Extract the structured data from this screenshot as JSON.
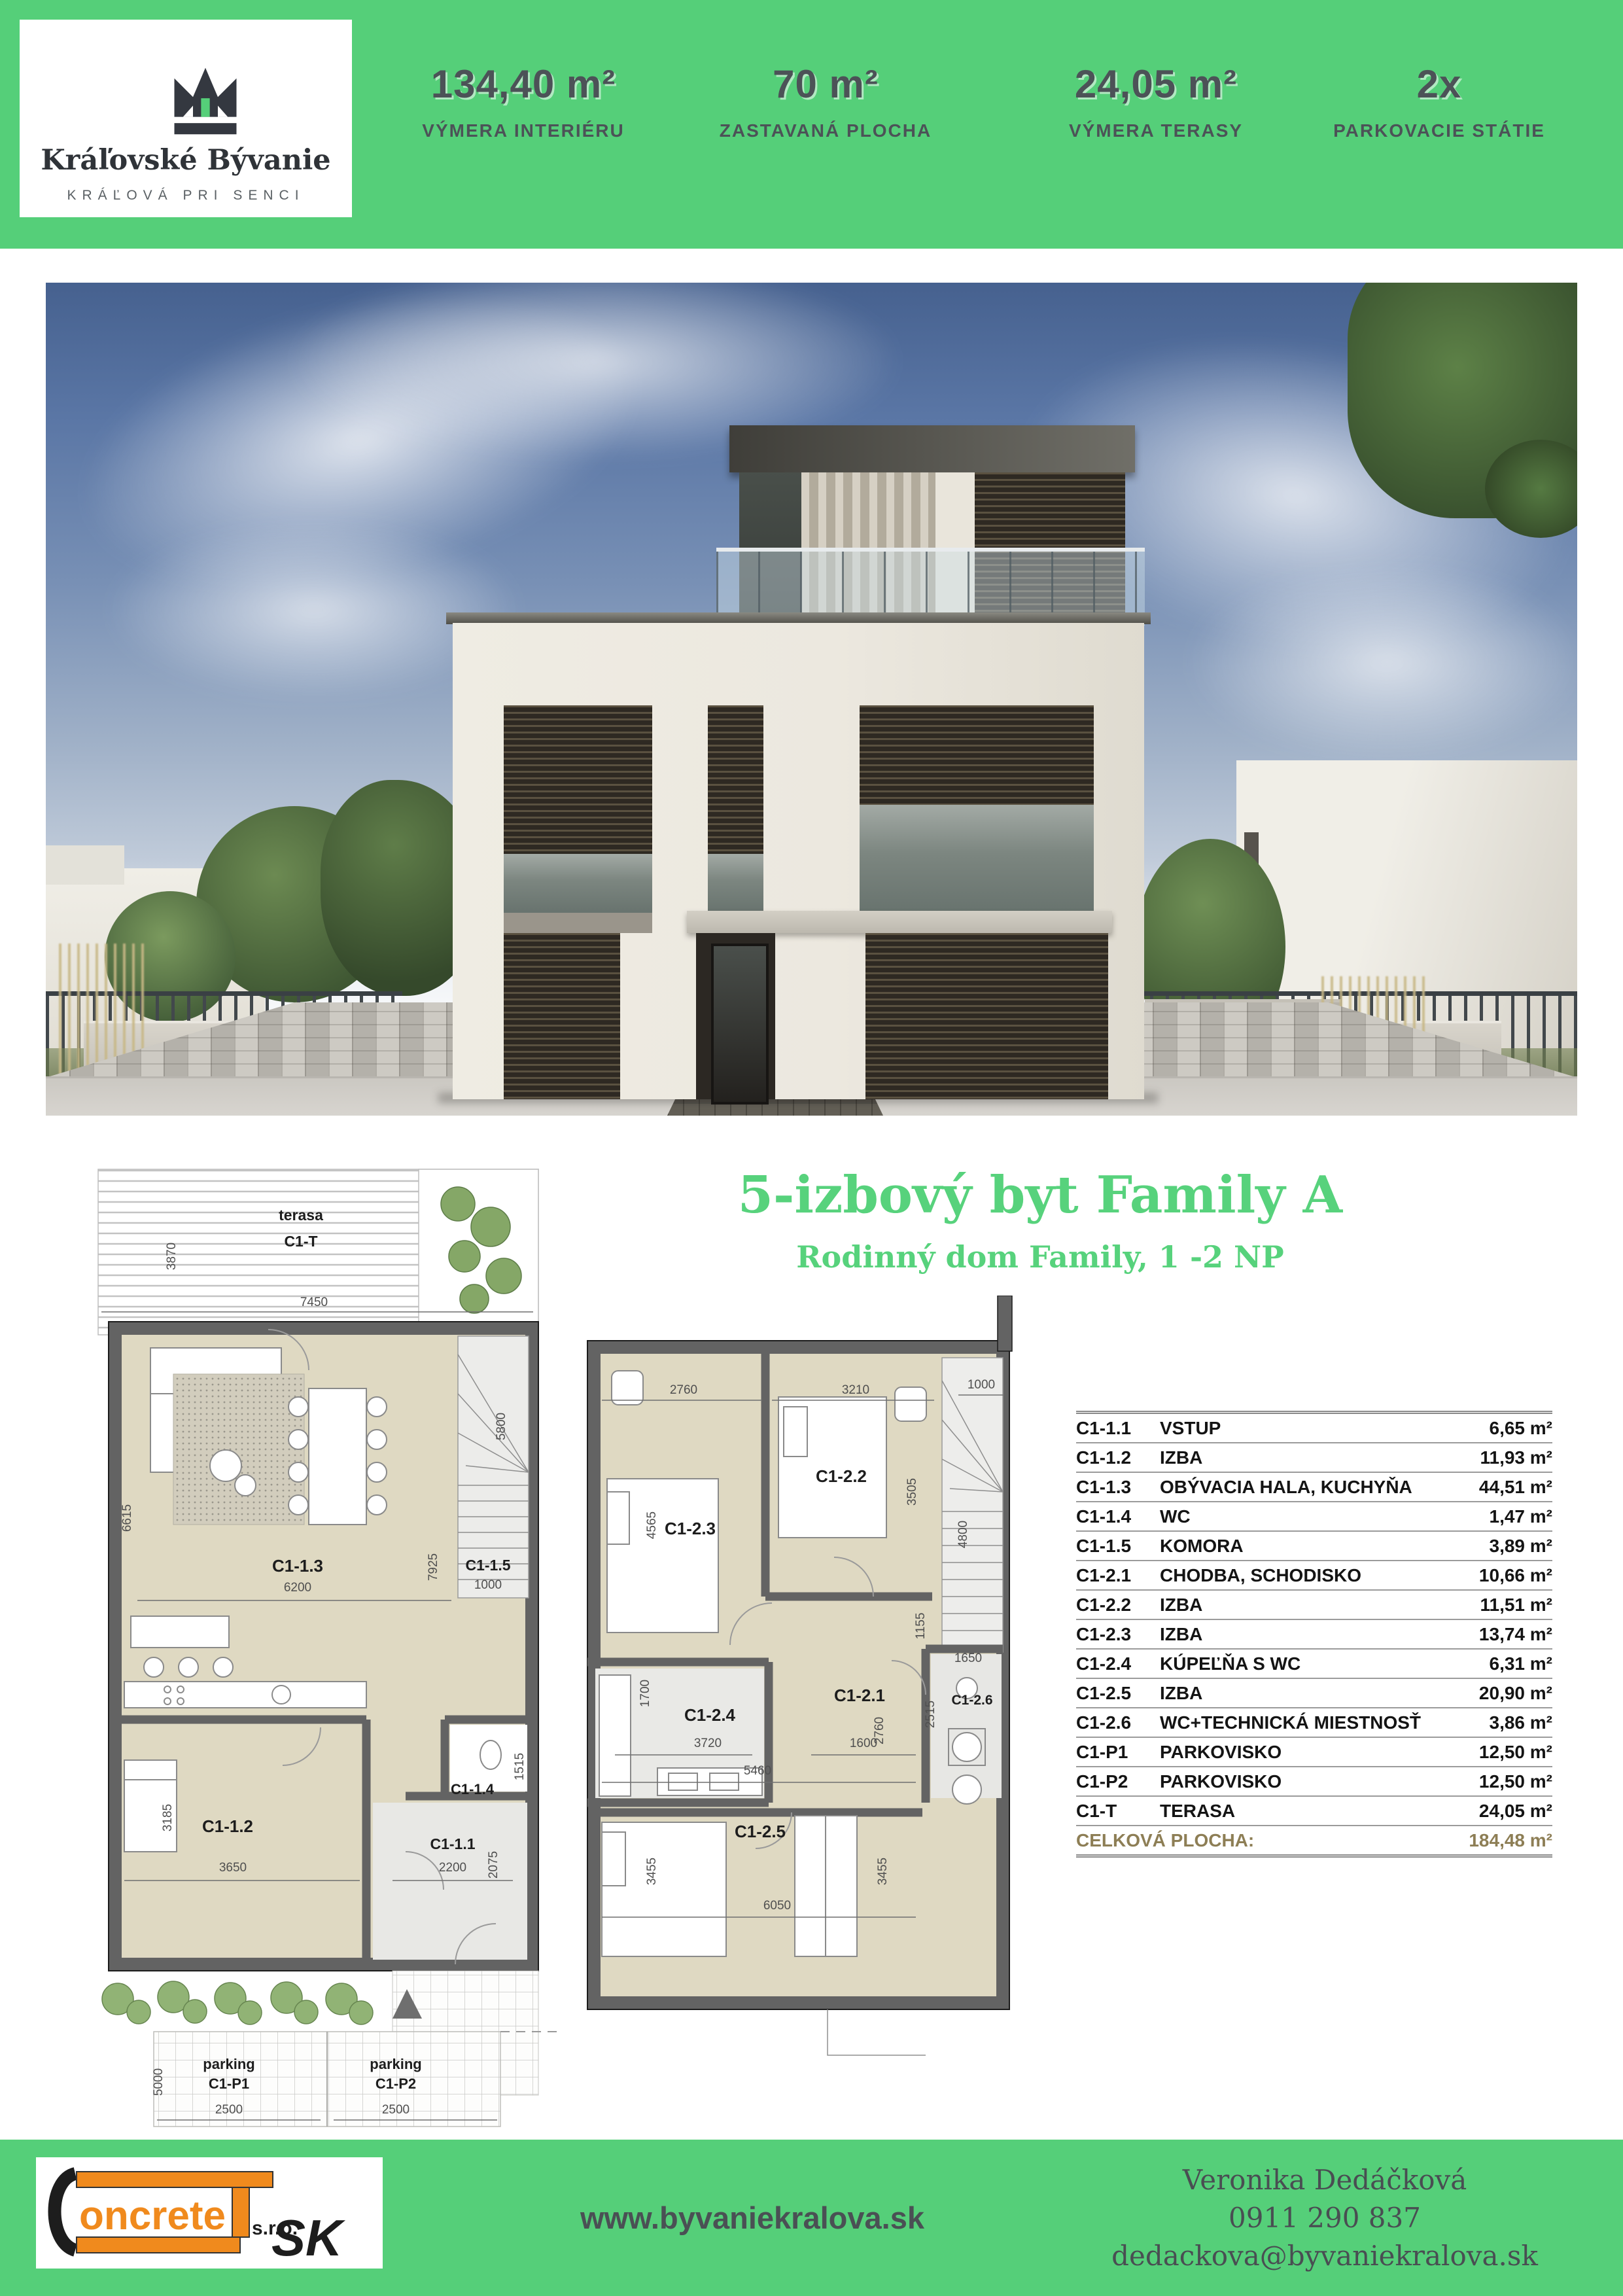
{
  "colors": {
    "green": "#55CF79",
    "dark_text": "#4C5257",
    "table_total": "#8D7E55",
    "logo_orange": "#F08A1D"
  },
  "header": {
    "logo": {
      "title": "Kráľovské Bývanie",
      "subtitle": "KRÁĽOVÁ PRI SENCI"
    },
    "stats": [
      {
        "value": "134,40 m²",
        "label": "VÝMERA INTERIÉRU"
      },
      {
        "value": "70 m²",
        "label": "ZASTAVANÁ PLOCHA"
      },
      {
        "value": "24,05 m²",
        "label": "VÝMERA TERASY"
      },
      {
        "value": "2x",
        "label": "PARKOVACIE STÁTIE"
      }
    ]
  },
  "section": {
    "title": "5-izbový byt Family A",
    "subtitle": "Rodinný dom Family,  1 -2 NP"
  },
  "plans": {
    "ground": {
      "terrace": {
        "name": "terasa",
        "code": "C1-T"
      },
      "rooms": {
        "c11": "C1-1.1",
        "c12": "C1-1.2",
        "c13": "C1-1.3",
        "c14": "C1-1.4",
        "c15": "C1-1.5"
      },
      "parking": {
        "p1a": "parking",
        "p1b": "C1-P1",
        "p2a": "parking",
        "p2b": "C1-P2"
      },
      "dims": {
        "t_w": "7450",
        "t_h": "3870",
        "liv_w": "6200",
        "liv_h": "6615",
        "liv_h2": "7925",
        "stair_h": "5800",
        "kom_w": "1000",
        "wc_h": "1515",
        "bed_w": "3650",
        "bed_h": "3185",
        "entry_w": "2200",
        "entry_h": "2075",
        "park_w1": "2500",
        "park_w2": "2500",
        "park_h": "5000"
      }
    },
    "upper": {
      "rooms": {
        "c21": "C1-2.1",
        "c22": "C1-2.2",
        "c23": "C1-2.3",
        "c24": "C1-2.4",
        "c25": "C1-2.5",
        "c26": "C1-2.6"
      },
      "dims": {
        "d1": "2760",
        "d2": "3210",
        "d3": "1000",
        "d4": "4565",
        "d5": "3505",
        "d6": "4800",
        "d7": "1155",
        "d8": "2760",
        "d9": "1700",
        "d10": "3720",
        "d11": "1600",
        "d12": "1650",
        "d13": "2515",
        "d14": "5460",
        "d15": "3455",
        "d16": "3455",
        "d17": "6050"
      }
    }
  },
  "table": {
    "rows": [
      {
        "code": "C1-1.1",
        "name": "VSTUP",
        "value": "6,65 m²"
      },
      {
        "code": "C1-1.2",
        "name": "IZBA",
        "value": "11,93 m²"
      },
      {
        "code": "C1-1.3",
        "name": "OBÝVACIA HALA, KUCHYŇA",
        "value": "44,51 m²"
      },
      {
        "code": "C1-1.4",
        "name": "WC",
        "value": "1,47 m²"
      },
      {
        "code": "C1-1.5",
        "name": "KOMORA",
        "value": "3,89 m²"
      },
      {
        "code": "C1-2.1",
        "name": "CHODBA, SCHODISKO",
        "value": "10,66 m²"
      },
      {
        "code": "C1-2.2",
        "name": "IZBA",
        "value": "11,51 m²"
      },
      {
        "code": "C1-2.3",
        "name": "IZBA",
        "value": "13,74 m²"
      },
      {
        "code": "C1-2.4",
        "name": "KÚPEĽŇA S WC",
        "value": "6,31 m²"
      },
      {
        "code": "C1-2.5",
        "name": "IZBA",
        "value": "20,90 m²"
      },
      {
        "code": "C1-2.6",
        "name": "WC+TECHNICKÁ MIESTNOSŤ",
        "value": "3,86 m²"
      },
      {
        "code": "C1-P1",
        "name": "PARKOVISKO",
        "value": "12,50 m²"
      },
      {
        "code": "C1-P2",
        "name": "PARKOVISKO",
        "value": "12,50 m²"
      },
      {
        "code": "C1-T",
        "name": "TERASA",
        "value": "24,05 m²"
      }
    ],
    "total": {
      "label": "CELKOVÁ PLOCHA:",
      "value": "184,48 m²"
    }
  },
  "footer": {
    "website": "www.byvaniekralova.sk",
    "contact": {
      "name": "Veronika Dedáčková",
      "phone": "0911 290 837",
      "email": "dedackova@byvaniekralova.sk"
    },
    "logo": {
      "initial": "C",
      "word": "oncrete",
      "suffix": "SK",
      "sro": "s.r.o."
    }
  }
}
